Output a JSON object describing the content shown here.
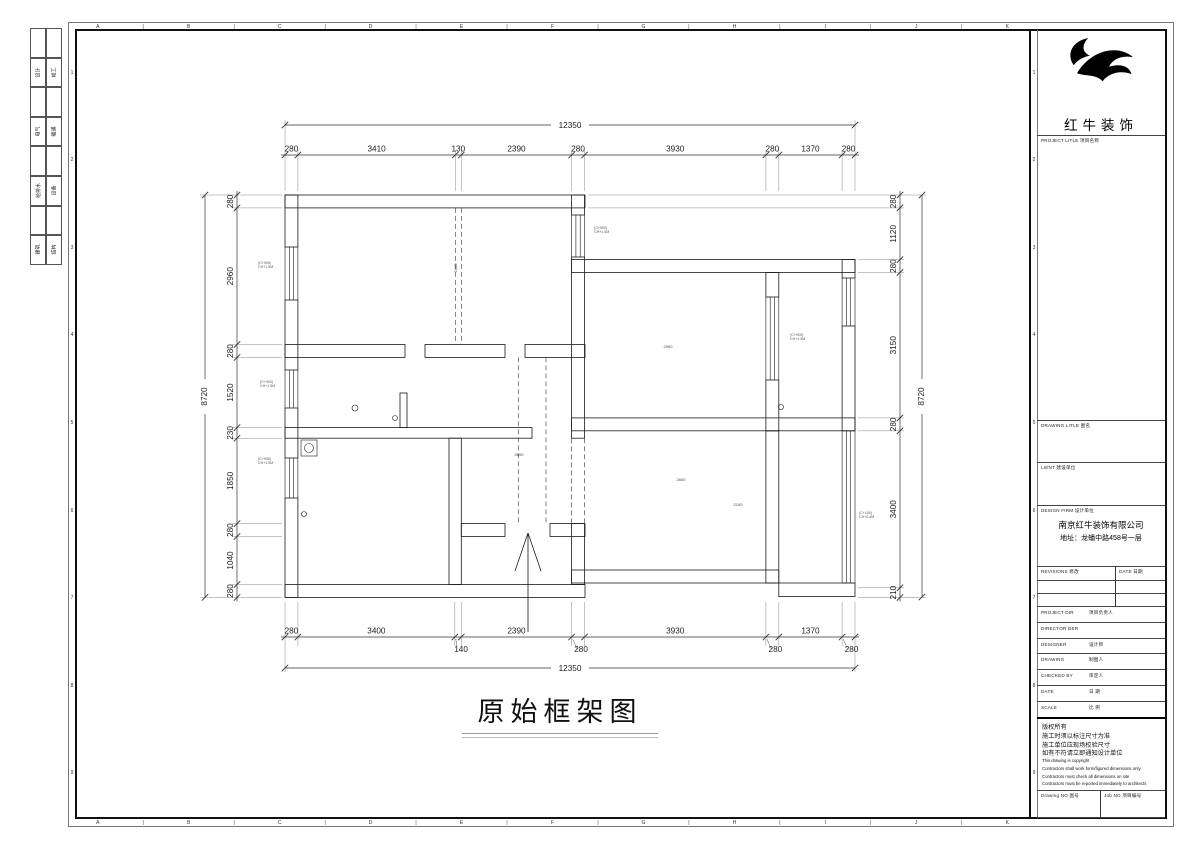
{
  "frame": {
    "grid_letters": [
      "A",
      "B",
      "C",
      "D",
      "E",
      "F",
      "G",
      "H",
      "I",
      "J",
      "K"
    ],
    "grid_separator": "|",
    "grid_numbers": [
      "1",
      "2",
      "3",
      "4",
      "5",
      "6",
      "7",
      "8",
      "9"
    ],
    "discipline_rows": [
      {
        "l": "设计",
        "r": "竣工"
      },
      {
        "l": "电气",
        "r": "暖通"
      },
      {
        "l": "给排水",
        "r": "设备"
      },
      {
        "l": "建筑",
        "r": "结构"
      }
    ]
  },
  "plan": {
    "title": "原始框架图",
    "dims": {
      "top": {
        "segments": [
          280,
          3410,
          130,
          2390,
          280,
          3930,
          280,
          1370,
          280
        ],
        "total": "12350"
      },
      "bottom": {
        "segments": [
          280,
          3400,
          140,
          2390,
          280,
          3930,
          280,
          1370,
          280
        ],
        "total": "12350"
      },
      "left": {
        "segments": [
          280,
          2960,
          280,
          1520,
          230,
          1850,
          280,
          1040,
          280
        ],
        "total": "8720"
      },
      "right": {
        "segments": [
          280,
          1120,
          280,
          3150,
          280,
          3400,
          210
        ],
        "total": "8720"
      }
    },
    "room_labels": [
      {
        "text": "2900",
        "x": 668,
        "y": 348
      },
      {
        "text": "3600",
        "x": 519,
        "y": 456
      },
      {
        "text": "2600",
        "x": 681,
        "y": 481
      },
      {
        "text": "2100",
        "x": 738,
        "y": 506
      },
      {
        "text": "2440",
        "x": 457,
        "y": 268,
        "rot": -90
      }
    ],
    "window_notes": [
      {
        "lines": [
          "(C+900)",
          "CH+1.5M"
        ],
        "x": 258,
        "y": 264
      },
      {
        "lines": [
          "(C+900)",
          "CH+1.5M"
        ],
        "x": 260,
        "y": 383
      },
      {
        "lines": [
          "(C+900)",
          "CH+1.5M"
        ],
        "x": 258,
        "y": 460
      },
      {
        "lines": [
          "(C+900)",
          "CH+1.5M"
        ],
        "x": 594,
        "y": 229
      },
      {
        "lines": [
          "(C+900)",
          "CH+1.5M"
        ],
        "x": 790,
        "y": 336
      },
      {
        "lines": [
          "(C+100)",
          "CH+2.4M"
        ],
        "x": 859,
        "y": 514
      }
    ]
  },
  "titleblock": {
    "brand": "红牛装饰",
    "project_title_label": "PROJECT LITLE  项目名称",
    "drawing_title_label": "DRAWING LITLE  图名",
    "client_label": "LIENT  建设单位",
    "design_firm_label": "DESIGN FIRM  设计单位",
    "design_firm_name": "南京红牛装饰有限公司",
    "design_firm_addr": "地址：龙蟠中路458号一层",
    "revisions_label": "REVISIONS  修改",
    "date_col_label": "DATE  日期",
    "staff_rows": [
      {
        "en": "PROJECT DIR",
        "zh": "项目负责人"
      },
      {
        "en": "DIRECTOR DER",
        "zh": ""
      },
      {
        "en": "DESIGNER",
        "zh": "设计师"
      },
      {
        "en": "DRAWING",
        "zh": "制图人"
      },
      {
        "en": "CHECKED BY",
        "zh": "审定人"
      },
      {
        "en": "DATE",
        "zh": "日  期"
      },
      {
        "en": "SCALE",
        "zh": "比  例"
      }
    ],
    "notes_zh": [
      "版权所有",
      "施工时须以标注尺寸为准",
      "施工单位应现场校验尺寸",
      "如有不符请立即通知设计单位"
    ],
    "notes_en": [
      "This drawing is copyright",
      "Contractors shall work form/figured dimensions only",
      "Contractors must check all dimensions on site",
      "Contractors must be reported immediately to architects"
    ],
    "drawing_no_label": "Drawing NO  图号",
    "job_no_label": "Job NO  项目编号"
  }
}
